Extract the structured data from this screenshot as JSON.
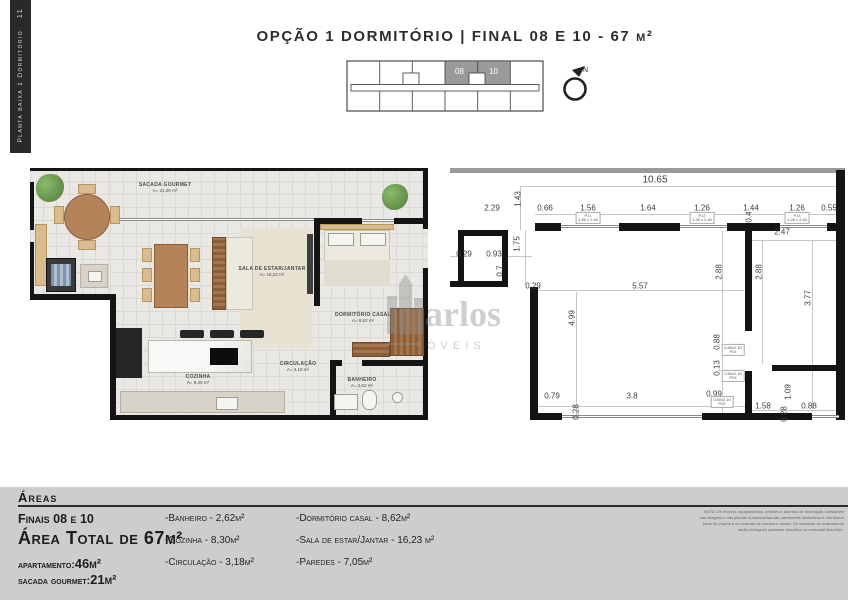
{
  "colors": {
    "wall": "#141414",
    "keyplan_highlight": "#9a9a9a",
    "footer_bg": "#cdcdcd",
    "plan_floor": "#eae8e4",
    "plant_green": "#6fa557",
    "wood": "#b5835a"
  },
  "sidebar": {
    "page_number": "11",
    "label": "Planta baixa 1 Dormitório"
  },
  "header": {
    "title": "OPÇÃO 1 DORMITÓRIO | FINAL 08 E 10 - 67 m²"
  },
  "keyplan": {
    "unit_left": "08",
    "unit_right": "10",
    "north": "N"
  },
  "floorplan": {
    "rooms": [
      {
        "name": "SACADA GOURMET",
        "area": "A= 21,00 m²"
      },
      {
        "name": "SALA DE ESTAR/JANTAR",
        "area": "A= 16,23 m²"
      },
      {
        "name": "DORMITÓRIO CASAL",
        "area": "A= 8,62 m²"
      },
      {
        "name": "COZINHA",
        "area": "A= 8,30 m²"
      },
      {
        "name": "CIRCULAÇÃO",
        "area": "A= 3,18 m²"
      },
      {
        "name": "BANHEIRO",
        "area": "A= 2,62 m²"
      }
    ]
  },
  "dimension_plan": {
    "dims": [
      "10.65",
      "2.29",
      "1.43",
      "0.66",
      "1.56",
      "1.64",
      "1.26",
      "1.44",
      "1.26",
      "0.55",
      "0.29",
      "0.93",
      "1.75",
      "0.7",
      "0.29",
      "5.57",
      "4.99",
      "2.88",
      "2.88",
      "0.4",
      "2.47",
      "3.77",
      "0.88",
      "0,13",
      "0.99",
      "0.79",
      "3.8",
      "0.28",
      "1.58",
      "1.09",
      "0.28",
      "0.88"
    ],
    "tags": [
      {
        "l1": "PJ1",
        "l2": "1.56 x 2.40"
      },
      {
        "l1": "PJ2",
        "l2": "1.26 x 2.40"
      },
      {
        "l1": "PJ3",
        "l2": "1.26 x 2.40"
      },
      {
        "l1": "0.80x2.10",
        "l2": "P01"
      },
      {
        "l1": "0.80x2.10",
        "l2": "P04"
      },
      {
        "l1": "0.80x2.10",
        "l2": "P02"
      }
    ]
  },
  "watermark": {
    "line1": "arlos",
    "line2": "ÓVEIS"
  },
  "footer": {
    "section_title": "Áreas",
    "finais": "Finais 08 e 10",
    "area_total": "Área Total de 67m²",
    "apartamento_label": "apartamento:",
    "apartamento_value": "46m²",
    "sacada_label": "sacada gourmet:",
    "sacada_value": "21m²",
    "col1": [
      "-Banheiro - 2,62m²",
      "-Cozinha - 8,30m²",
      "-Circulação - 3,18m²"
    ],
    "col2": [
      "-Dormitório casal - 8,62m²",
      "-Sala de estar/Jantar - 16,23 m²",
      "-Paredes - 7,05m²"
    ],
    "note": "NOTA: Os móveis, equipamentos, enfeites e adornos de decoração constantes nas imagens e nas plantas humanizadas são meramente ilustrativos e não fazem parte do projeto e do contrato de compra e venda. Os materiais de acabamento serão entregues conforme descritos no memorial descritivo."
  }
}
